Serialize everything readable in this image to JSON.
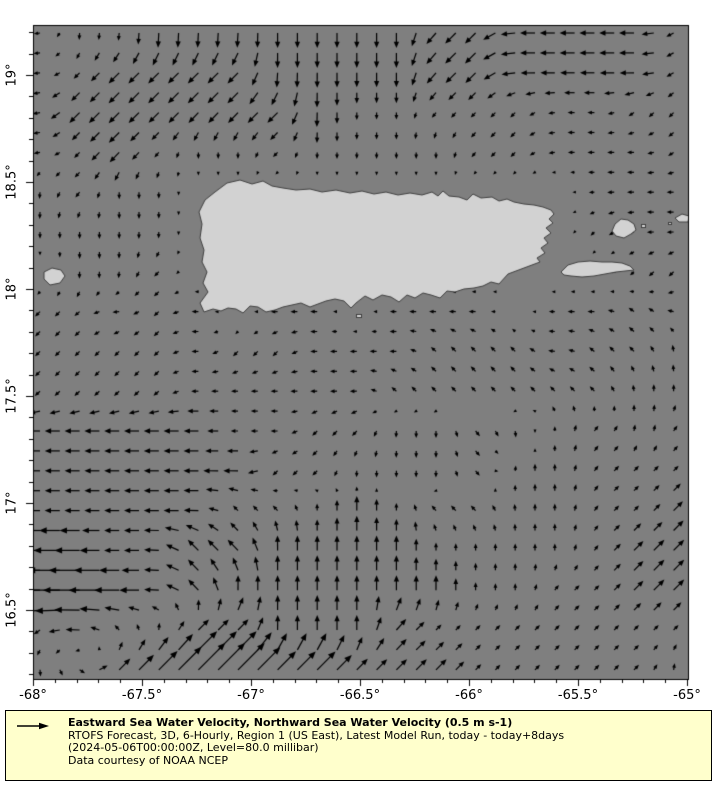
{
  "figure": {
    "background": "#ffffff"
  },
  "map": {
    "region": "Puerto Rico and surrounding waters",
    "ocean_color": "#7f7f7f",
    "land_color": "#d2d2d2",
    "coastline_color": "#404040",
    "lon_range": [
      -68,
      -65
    ],
    "lat_range": [
      16.18,
      19.23
    ],
    "land_polygons": {
      "puerto_rico": [
        [
          227,
          183
        ],
        [
          240,
          180
        ],
        [
          252,
          184
        ],
        [
          263,
          181
        ],
        [
          272,
          186
        ],
        [
          283,
          188
        ],
        [
          296,
          190
        ],
        [
          310,
          189
        ],
        [
          322,
          192
        ],
        [
          336,
          190
        ],
        [
          350,
          193
        ],
        [
          362,
          191
        ],
        [
          374,
          194
        ],
        [
          386,
          192
        ],
        [
          398,
          195
        ],
        [
          410,
          193
        ],
        [
          422,
          195
        ],
        [
          432,
          192
        ],
        [
          438,
          196
        ],
        [
          443,
          191
        ],
        [
          449,
          196
        ],
        [
          459,
          197
        ],
        [
          467,
          200
        ],
        [
          473,
          194
        ],
        [
          481,
          198
        ],
        [
          492,
          197
        ],
        [
          499,
          201
        ],
        [
          507,
          199
        ],
        [
          514,
          202
        ],
        [
          524,
          204
        ],
        [
          534,
          205
        ],
        [
          543,
          207
        ],
        [
          551,
          210
        ],
        [
          554,
          214
        ],
        [
          549,
          219
        ],
        [
          553,
          223
        ],
        [
          546,
          228
        ],
        [
          551,
          233
        ],
        [
          544,
          238
        ],
        [
          548,
          243
        ],
        [
          541,
          248
        ],
        [
          545,
          253
        ],
        [
          537,
          258
        ],
        [
          540,
          262
        ],
        [
          532,
          265
        ],
        [
          524,
          268
        ],
        [
          516,
          271
        ],
        [
          508,
          274
        ],
        [
          499,
          284
        ],
        [
          491,
          282
        ],
        [
          483,
          286
        ],
        [
          474,
          288
        ],
        [
          464,
          289
        ],
        [
          455,
          292
        ],
        [
          447,
          291
        ],
        [
          440,
          298
        ],
        [
          431,
          295
        ],
        [
          423,
          293
        ],
        [
          415,
          298
        ],
        [
          407,
          295
        ],
        [
          399,
          302
        ],
        [
          391,
          297
        ],
        [
          382,
          295
        ],
        [
          373,
          300
        ],
        [
          365,
          296
        ],
        [
          356,
          303
        ],
        [
          351,
          308
        ],
        [
          344,
          301
        ],
        [
          335,
          299
        ],
        [
          326,
          301
        ],
        [
          318,
          304
        ],
        [
          310,
          307
        ],
        [
          301,
          303
        ],
        [
          292,
          305
        ],
        [
          283,
          307
        ],
        [
          275,
          310
        ],
        [
          266,
          312
        ],
        [
          258,
          307
        ],
        [
          250,
          306
        ],
        [
          243,
          313
        ],
        [
          236,
          309
        ],
        [
          228,
          308
        ],
        [
          221,
          311
        ],
        [
          213,
          309
        ],
        [
          204,
          312
        ],
        [
          200,
          303
        ],
        [
          208,
          292
        ],
        [
          203,
          283
        ],
        [
          207,
          272
        ],
        [
          202,
          262
        ],
        [
          204,
          250
        ],
        [
          200,
          238
        ],
        [
          202,
          224
        ],
        [
          199,
          212
        ],
        [
          205,
          200
        ],
        [
          215,
          192
        ]
      ],
      "vieques": [
        [
          561,
          272
        ],
        [
          568,
          265
        ],
        [
          578,
          262
        ],
        [
          590,
          261
        ],
        [
          602,
          262
        ],
        [
          612,
          262
        ],
        [
          622,
          263
        ],
        [
          630,
          266
        ],
        [
          634,
          270
        ],
        [
          625,
          271
        ],
        [
          616,
          272
        ],
        [
          605,
          274
        ],
        [
          594,
          276
        ],
        [
          582,
          277
        ],
        [
          571,
          276
        ],
        [
          564,
          275
        ]
      ],
      "culebra": [
        [
          612,
          231
        ],
        [
          615,
          224
        ],
        [
          621,
          219
        ],
        [
          628,
          220
        ],
        [
          634,
          224
        ],
        [
          636,
          230
        ],
        [
          631,
          234
        ],
        [
          624,
          238
        ],
        [
          616,
          236
        ]
      ],
      "mona": [
        [
          44,
          272
        ],
        [
          52,
          268
        ],
        [
          61,
          270
        ],
        [
          65,
          276
        ],
        [
          60,
          283
        ],
        [
          50,
          285
        ],
        [
          44,
          279
        ]
      ],
      "culebrita": [
        [
          675,
          218
        ],
        [
          682,
          214
        ],
        [
          689,
          216
        ],
        [
          688,
          222
        ],
        [
          679,
          222
        ]
      ]
    },
    "islets": [
      [
        356,
        314,
        5,
        3
      ],
      [
        641,
        224,
        4,
        3
      ],
      [
        668,
        222,
        3,
        2
      ]
    ]
  },
  "axes": {
    "lon_ticks": [
      {
        "value": -68,
        "label": "-68°"
      },
      {
        "value": -67.5,
        "label": "-67.5°"
      },
      {
        "value": -67,
        "label": "-67°"
      },
      {
        "value": -66.5,
        "label": "-66.5°"
      },
      {
        "value": -66,
        "label": "-66°"
      },
      {
        "value": -65.5,
        "label": "-65.5°"
      },
      {
        "value": -65,
        "label": "-65°"
      }
    ],
    "lat_ticks": [
      {
        "value": 19,
        "label": "19°"
      },
      {
        "value": 18.5,
        "label": "18.5°"
      },
      {
        "value": 18,
        "label": "18°"
      },
      {
        "value": 17.5,
        "label": "17.5°"
      },
      {
        "value": 17,
        "label": "17°"
      },
      {
        "value": 16.5,
        "label": "16.5°"
      }
    ],
    "minor_tick_interval_deg": 0.1
  },
  "vector_field": {
    "units": "m s-1",
    "reference_speed": "0.5",
    "arrow_color": "#000000",
    "note": "Coarse 17x17 grid of current direction+strength tokens transcribed from the quiver plot; rows run north to south, columns west to east; token = compass direction + magnitude 1-4; 0 = calm or land.",
    "magnitude_px": {
      "1": 7,
      "2": 15,
      "3": 26,
      "4": 38
    },
    "rows": [
      [
        "W1",
        "S1",
        "S1",
        "S2",
        "S2",
        "S2",
        "S2",
        "S2",
        "S2",
        "S2",
        "SW2",
        "SW2",
        "W2",
        "W2",
        "W2",
        "W2",
        "SW1"
      ],
      [
        "W1",
        "SW1",
        "SW2",
        "SW2",
        "SW2",
        "SW2",
        "S2",
        "S2",
        "S2",
        "S2",
        "SW2",
        "SW2",
        "W2",
        "W2",
        "W2",
        "W2",
        "SW1"
      ],
      [
        "W1",
        "SW2",
        "SW2",
        "SW2",
        "SW2",
        "SW2",
        "SW2",
        "S2",
        "S1",
        "S1",
        "SW1",
        "SW1",
        "SW1",
        "W1",
        "W1",
        "SW1",
        "SW1"
      ],
      [
        "W1",
        "SW1",
        "SW2",
        "SW1",
        "S1",
        "S1",
        "SW1",
        "S1",
        "S1",
        "S1",
        "S1",
        "SW1",
        "SW1",
        "W1",
        "W1",
        "W1",
        "SW1"
      ],
      [
        "S1",
        "SW1",
        "S1",
        "S1",
        "0",
        "0",
        "0",
        "0",
        "0",
        "0",
        "0",
        "0",
        "0",
        "0",
        "W1",
        "W1",
        "W1"
      ],
      [
        "S1",
        "S1",
        "S1",
        "S1",
        "0",
        "0",
        "0",
        "0",
        "0",
        "0",
        "0",
        "0",
        "0",
        "0",
        "SW1",
        "W1",
        "W1"
      ],
      [
        "0",
        "S1",
        "S1",
        "SW1",
        "0",
        "0",
        "0",
        "0",
        "0",
        "0",
        "0",
        "0",
        "0",
        "0",
        "0",
        "SW1",
        "SW1"
      ],
      [
        "SW1",
        "SW1",
        "W1",
        "SW1",
        "W1",
        "0",
        "W1",
        "W1",
        "0",
        "W1",
        "W1",
        "W1",
        "0",
        "W1",
        "W1",
        "NW1",
        "W1"
      ],
      [
        "SW1",
        "SW1",
        "SW1",
        "SW1",
        "W1",
        "SW1",
        "SW1",
        "W1",
        "W1",
        "W1",
        "NW1",
        "NW1",
        "NW1",
        "W1",
        "NW1",
        "NW1",
        "N1"
      ],
      [
        "SW1",
        "SW1",
        "SW1",
        "SW1",
        "W1",
        "W1",
        "W1",
        "W1",
        "W1",
        "NW1",
        "NW1",
        "NW1",
        "NW1",
        "NW1",
        "NW1",
        "N1",
        "N1"
      ],
      [
        "W2",
        "W2",
        "W2",
        "W2",
        "W2",
        "W1",
        "W1",
        "SW1",
        "SW1",
        "S1",
        "S1",
        "SE1",
        "S1",
        "N1",
        "NE1",
        "N1",
        "NE1"
      ],
      [
        "W2",
        "W2",
        "W2",
        "W2",
        "W2",
        "W2",
        "SW1",
        "SW1",
        "S1",
        "S1",
        "S1",
        "SE1",
        "N1",
        "N1",
        "NE1",
        "NE1",
        "NE1"
      ],
      [
        "W2",
        "W2",
        "W2",
        "W2",
        "W2",
        "NW1",
        "NW1",
        "N1",
        "N2",
        "N1",
        "NW1",
        "NW1",
        "N1",
        "N1",
        "NE1",
        "NE1",
        "NE2"
      ],
      [
        "W3",
        "W3",
        "W2",
        "W2",
        "NW2",
        "NW2",
        "N2",
        "N2",
        "N2",
        "N2",
        "N1",
        "N1",
        "N1",
        "N1",
        "NE1",
        "NE2",
        "NE2"
      ],
      [
        "W4",
        "W4",
        "W3",
        "W2",
        "NW2",
        "N2",
        "N2",
        "N2",
        "N2",
        "N2",
        "N2",
        "N1",
        "N1",
        "NE1",
        "NE1",
        "NE2",
        "NE2"
      ],
      [
        "SW1",
        "W2",
        "NW1",
        "N1",
        "NE2",
        "NE2",
        "N2",
        "N2",
        "N2",
        "NE2",
        "NE1",
        "NE1",
        "NE1",
        "NE1",
        "NE1",
        "NE1",
        "NE1"
      ],
      [
        "S1",
        "SE1",
        "NE2",
        "NE3",
        "NE4",
        "NE4",
        "NE3",
        "NE3",
        "NE2",
        "NE2",
        "NE2",
        "NE1",
        "NE1",
        "NE1",
        "NE1",
        "NE1",
        "N1"
      ]
    ]
  },
  "legend": {
    "background": "#ffffcc",
    "border_color": "#000000",
    "title": "Eastward Sea Water Velocity, Northward Sea Water Velocity (0.5 m s-1)",
    "line2": "RTOFS Forecast, 3D, 6-Hourly, Region 1 (US East), Latest Model Run, today - today+8days",
    "line3": "(2024-05-06T00:00:00Z, Level=80.0 millibar)",
    "line4": "Data courtesy of NOAA NCEP"
  }
}
